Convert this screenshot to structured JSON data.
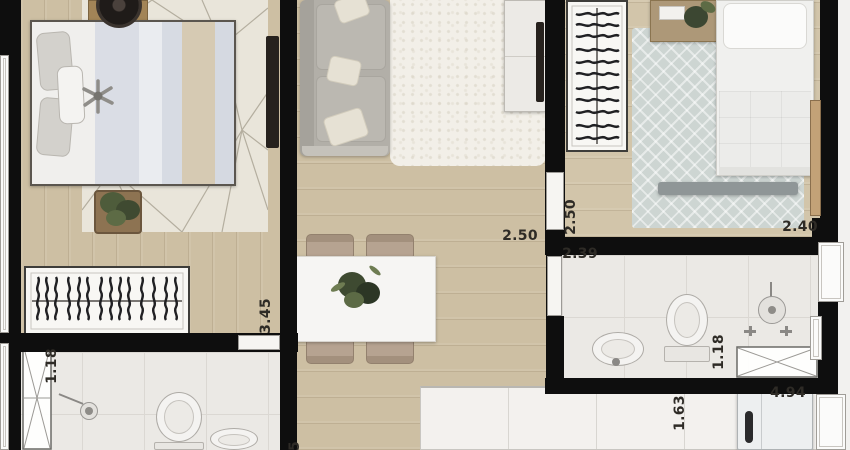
{
  "canvas": {
    "width": 850,
    "height": 450
  },
  "palette": {
    "wall": "#0e0e0e",
    "wood_floor": "#cdbfa3",
    "tile_floor": "#ebe9e5",
    "rug_cream": "#e9e5da",
    "rug_shag": "#f2efe8",
    "rug_blue_gray": "#cdd5d2",
    "sofa_gray": "#b2afa8",
    "bed_linen": "#efefed",
    "blanket_blue_gray": "#d9dce4",
    "blanket_tan": "#d6cab3",
    "chair_tan": "#b3a08e",
    "counter_white": "#f3f1ee",
    "label_color": "#2e2b26"
  },
  "dimension_labels": [
    {
      "id": "dim-living-250",
      "text": "2.50",
      "orientation": "horizontal"
    },
    {
      "id": "dim-bedroom2-250",
      "text": "2.50",
      "orientation": "vertical"
    },
    {
      "id": "dim-bedroom2-240",
      "text": "2.40",
      "orientation": "horizontal"
    },
    {
      "id": "dim-bath2-239",
      "text": "2.39",
      "orientation": "horizontal"
    },
    {
      "id": "dim-bedroom1-345",
      "text": "3.45",
      "orientation": "vertical"
    },
    {
      "id": "dim-bath1-118",
      "text": "1.18",
      "orientation": "vertical"
    },
    {
      "id": "dim-bath2-118",
      "text": "1.18",
      "orientation": "vertical"
    },
    {
      "id": "dim-kitchen-163",
      "text": "1.63",
      "orientation": "vertical"
    },
    {
      "id": "dim-kitchen-494",
      "text": "4.94",
      "orientation": "horizontal"
    },
    {
      "id": "dim-partial-5",
      "text": "5",
      "orientation": "vertical"
    }
  ],
  "furniture_icons": [
    "double-bed",
    "wardrobe-clothes",
    "tv-panel",
    "speaker",
    "plant",
    "sofa",
    "shag-rug",
    "tv-sideboard",
    "single-bed",
    "nightstand",
    "zigzag-rug",
    "dining-table",
    "dining-chair",
    "centerpiece-plant",
    "kitchen-counter",
    "refrigerator",
    "toilet",
    "sink",
    "shower-head",
    "shower-glass",
    "window",
    "door"
  ]
}
